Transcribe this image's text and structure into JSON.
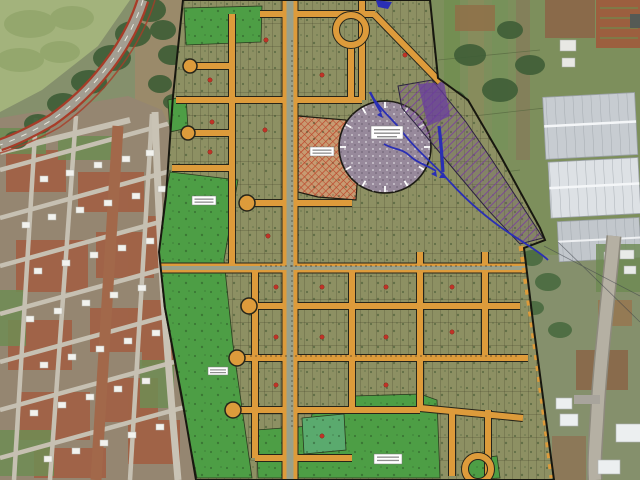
{
  "meta": {
    "title": "Satellite aerial photo with residential subdivision (lot) plan overlay",
    "description": "Aerial/satellite view: curved highway and small town grid on the left, farm plots and white industrial sheds on the right, with a proposed subdivision plan overlaid in the center showing orange streets, lot blocks, green areas, a circular plaza, hatched reserve areas and blue stream lines. No map text is legible at this resolution.",
    "width_px": 640,
    "height_px": 480,
    "legible_text_present": false
  },
  "map": {
    "colors": {
      "street_orange": "#dd9b3b",
      "block_outline": "#26251a",
      "lot_fill": "#8d9063",
      "green_area": "#4d9e45",
      "green_area_bright": "#5aaa6e",
      "plan_boundary": "#17170f",
      "highway_edge_red": "#a83c28",
      "asphalt": "#a39e92",
      "stream_blue": "#2a2fb4",
      "commercial_hatch_red": "#c0452a",
      "commercial_base_tan": "#c79b72",
      "preservation_hatch_purple": "#7a3f9e",
      "plaza_fill": "#97899b",
      "town_soil_red": "#a35b3e",
      "field_green": "#a3b37c",
      "warehouse_roof_gray": "#c7ccd1",
      "road_gray": "#b5b0a3",
      "house_roof_white": "#f2f2ee",
      "label_box_white": "#ffffff",
      "block_number_red": "#c13327"
    },
    "features": [
      {
        "id": "highway",
        "label": "curved highway with red edge lines, top-left"
      },
      {
        "id": "rural-town-grid",
        "label": "existing town street grid with white-roofed houses, left"
      },
      {
        "id": "subdivision-plan",
        "label": "overlaid subdivision plan with orange streets and small lots, center"
      },
      {
        "id": "central-plaza-circle",
        "label": "large circular plaza/roundabout with center label box"
      },
      {
        "id": "commercial-hatch-area",
        "label": "red cross-hatched reserved block beside the main avenue"
      },
      {
        "id": "preservation-hatch-area",
        "label": "purple hatched preservation strip along the stream"
      },
      {
        "id": "stream",
        "label": "blue stream / drainage lines with flow arrows"
      },
      {
        "id": "green-areas",
        "label": "bright green public green areas inside the plan"
      },
      {
        "id": "warehouses",
        "label": "large white industrial sheds, right side"
      },
      {
        "id": "main-road-right",
        "label": "gray road running down the right edge"
      },
      {
        "id": "farm-fields",
        "label": "cultivated strip plots, top right"
      }
    ],
    "labels": [
      {
        "id": "plaza-label",
        "legible": false,
        "lines": 3
      },
      {
        "id": "green-area-label-west",
        "legible": false,
        "lines": 2
      },
      {
        "id": "commercial-area-label",
        "legible": false,
        "lines": 2
      },
      {
        "id": "green-area-label-south",
        "legible": false,
        "lines": 2
      },
      {
        "id": "green-strip-label",
        "legible": false,
        "lines": 2
      }
    ],
    "block_markers": {
      "shape": "small red block numbers at block centers",
      "count_visible": 18
    }
  }
}
